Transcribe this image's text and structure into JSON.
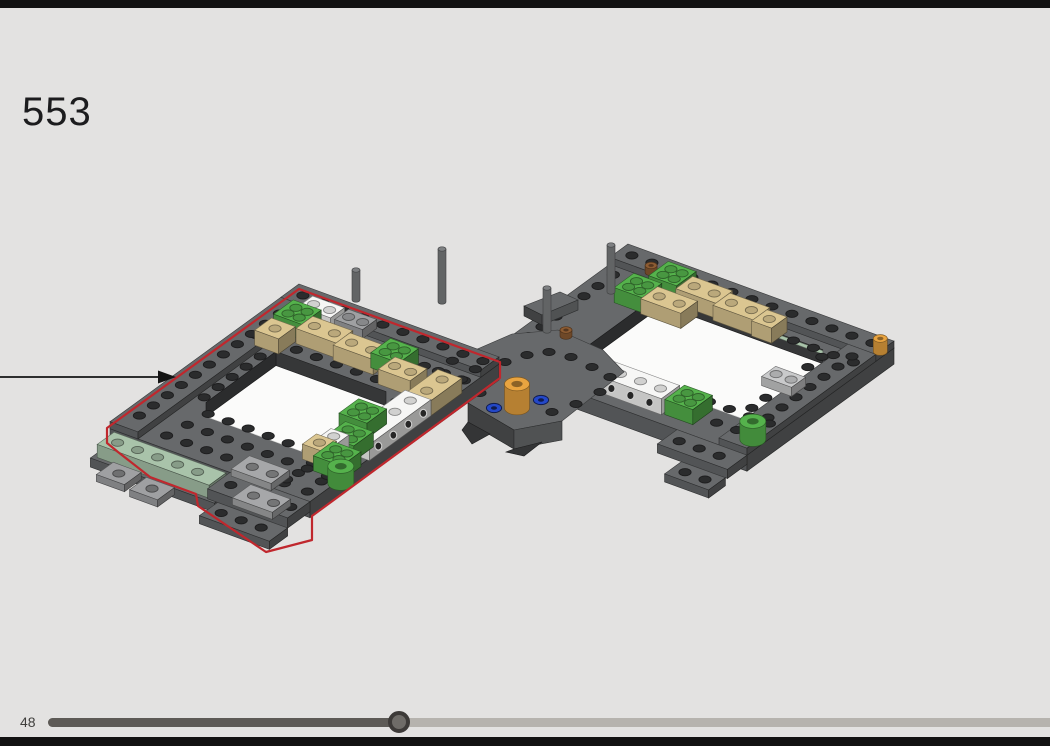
{
  "step": {
    "number": "553"
  },
  "pager": {
    "page_label": "48",
    "progress_fraction": 0.35
  },
  "model": {
    "arrow_icon": "arrow-right-icon",
    "highlight_outline_color": "#c0272d"
  },
  "colors": {
    "background": "#e3e2e1",
    "chrome_bar": "#121212",
    "step_text": "#1c1c1e",
    "page_text": "#3f3e3c",
    "slider_fill": "#5d5a56",
    "slider_track": "#b6b3ae",
    "slider_thumb": "#6f6c68",
    "slider_thumb_ring": "#3d3a38",
    "arrow": "#141414",
    "highlight_red": "#c0272d",
    "brick_dark_gray": "#67696b",
    "brick_medium_gray": "#9fa0a2",
    "brick_light_gray": "#c9cacb",
    "brick_green": "#55b24c",
    "brick_tan": "#dbc691",
    "brick_white": "#f6f6f5",
    "brick_sand_green": "#a9c3aa",
    "brick_orange": "#e9a440",
    "brick_blue": "#2448c8",
    "brick_brown": "#8d5c33",
    "brick_pin_gray": "#7e8082"
  }
}
